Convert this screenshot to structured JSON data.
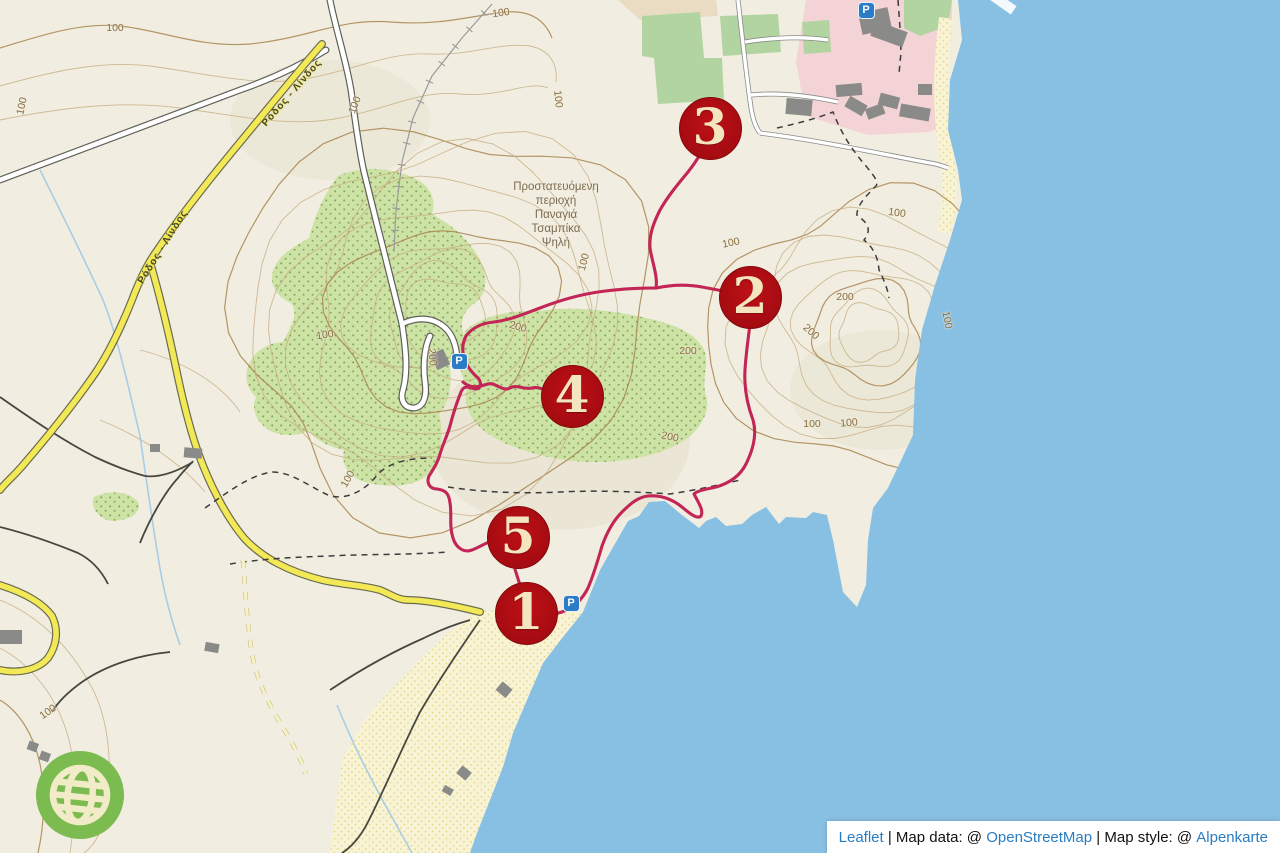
{
  "window": {
    "width": 1280,
    "height": 853,
    "app": "Leaflet interactive hiking map"
  },
  "colors": {
    "land": "#f1eee1",
    "sea": "#88c0e3",
    "forest_fill": "#cde2a5",
    "forest_dot": "#84a457",
    "park_green": "#b2d4a0",
    "urban_pink": "#f3d3d5",
    "beach_sand": "#f8f3d4",
    "contour": "#c6ab80",
    "contour_index": "#a8854f",
    "route": "#c22556",
    "marker_red": "#a80c12",
    "marker_text": "#f3e5c0",
    "road_yellow": "#f3e956",
    "parking_blue": "#2a7cc7",
    "link_blue": "#2a7cc0",
    "logo_green": "#7cbb4f"
  },
  "markers": [
    {
      "label": "1",
      "x": 526,
      "y": 613
    },
    {
      "label": "2",
      "x": 750,
      "y": 297
    },
    {
      "label": "3",
      "x": 710,
      "y": 128
    },
    {
      "label": "4",
      "x": 572,
      "y": 396
    },
    {
      "label": "5",
      "x": 518,
      "y": 537
    }
  ],
  "parking": [
    {
      "x": 866,
      "y": 10
    },
    {
      "x": 459,
      "y": 361
    },
    {
      "x": 571,
      "y": 603
    }
  ],
  "labels": {
    "area": {
      "x": 556,
      "y": 180,
      "lines": [
        "Προστατευόμενη",
        "περιοχή",
        "Παναγιά",
        "Τσαμπίκα",
        "Ψηλή"
      ]
    },
    "roads": [
      {
        "text": "Ρόδος - Λίνδος",
        "x": 292,
        "y": 93,
        "rot": -49
      },
      {
        "text": "Ρόδος - Λίνδος",
        "x": 163,
        "y": 247,
        "rot": -58
      }
    ],
    "contours": [
      {
        "text": "100",
        "x": 115,
        "y": 28,
        "rot": 0
      },
      {
        "text": "100",
        "x": 501,
        "y": 13,
        "rot": -8
      },
      {
        "text": "100",
        "x": 22,
        "y": 106,
        "rot": -78
      },
      {
        "text": "100",
        "x": 355,
        "y": 105,
        "rot": -68
      },
      {
        "text": "100",
        "x": 558,
        "y": 99,
        "rot": 84
      },
      {
        "text": "100",
        "x": 584,
        "y": 262,
        "rot": -75
      },
      {
        "text": "100",
        "x": 731,
        "y": 243,
        "rot": -12
      },
      {
        "text": "100",
        "x": 897,
        "y": 213,
        "rot": 8
      },
      {
        "text": "200",
        "x": 845,
        "y": 297,
        "rot": 0
      },
      {
        "text": "200",
        "x": 811,
        "y": 332,
        "rot": 42
      },
      {
        "text": "100",
        "x": 947,
        "y": 320,
        "rot": 78
      },
      {
        "text": "200",
        "x": 518,
        "y": 327,
        "rot": 15
      },
      {
        "text": "200",
        "x": 432,
        "y": 357,
        "rot": 84
      },
      {
        "text": "200",
        "x": 688,
        "y": 351,
        "rot": 0
      },
      {
        "text": "200",
        "x": 670,
        "y": 437,
        "rot": 12
      },
      {
        "text": "100",
        "x": 812,
        "y": 424,
        "rot": 0
      },
      {
        "text": "100",
        "x": 849,
        "y": 423,
        "rot": -5
      },
      {
        "text": "100",
        "x": 325,
        "y": 335,
        "rot": -8
      },
      {
        "text": "100",
        "x": 348,
        "y": 479,
        "rot": -60
      },
      {
        "text": "100",
        "x": 48,
        "y": 712,
        "rot": -35
      }
    ]
  },
  "attribution": {
    "segments": [
      {
        "text": "Leaflet",
        "link": true
      },
      {
        "text": " | Map data: @ ",
        "link": false
      },
      {
        "text": "OpenStreetMap",
        "link": true
      },
      {
        "text": " | Map style: @ ",
        "link": false
      },
      {
        "text": "Alpenkarte",
        "link": true
      }
    ]
  }
}
